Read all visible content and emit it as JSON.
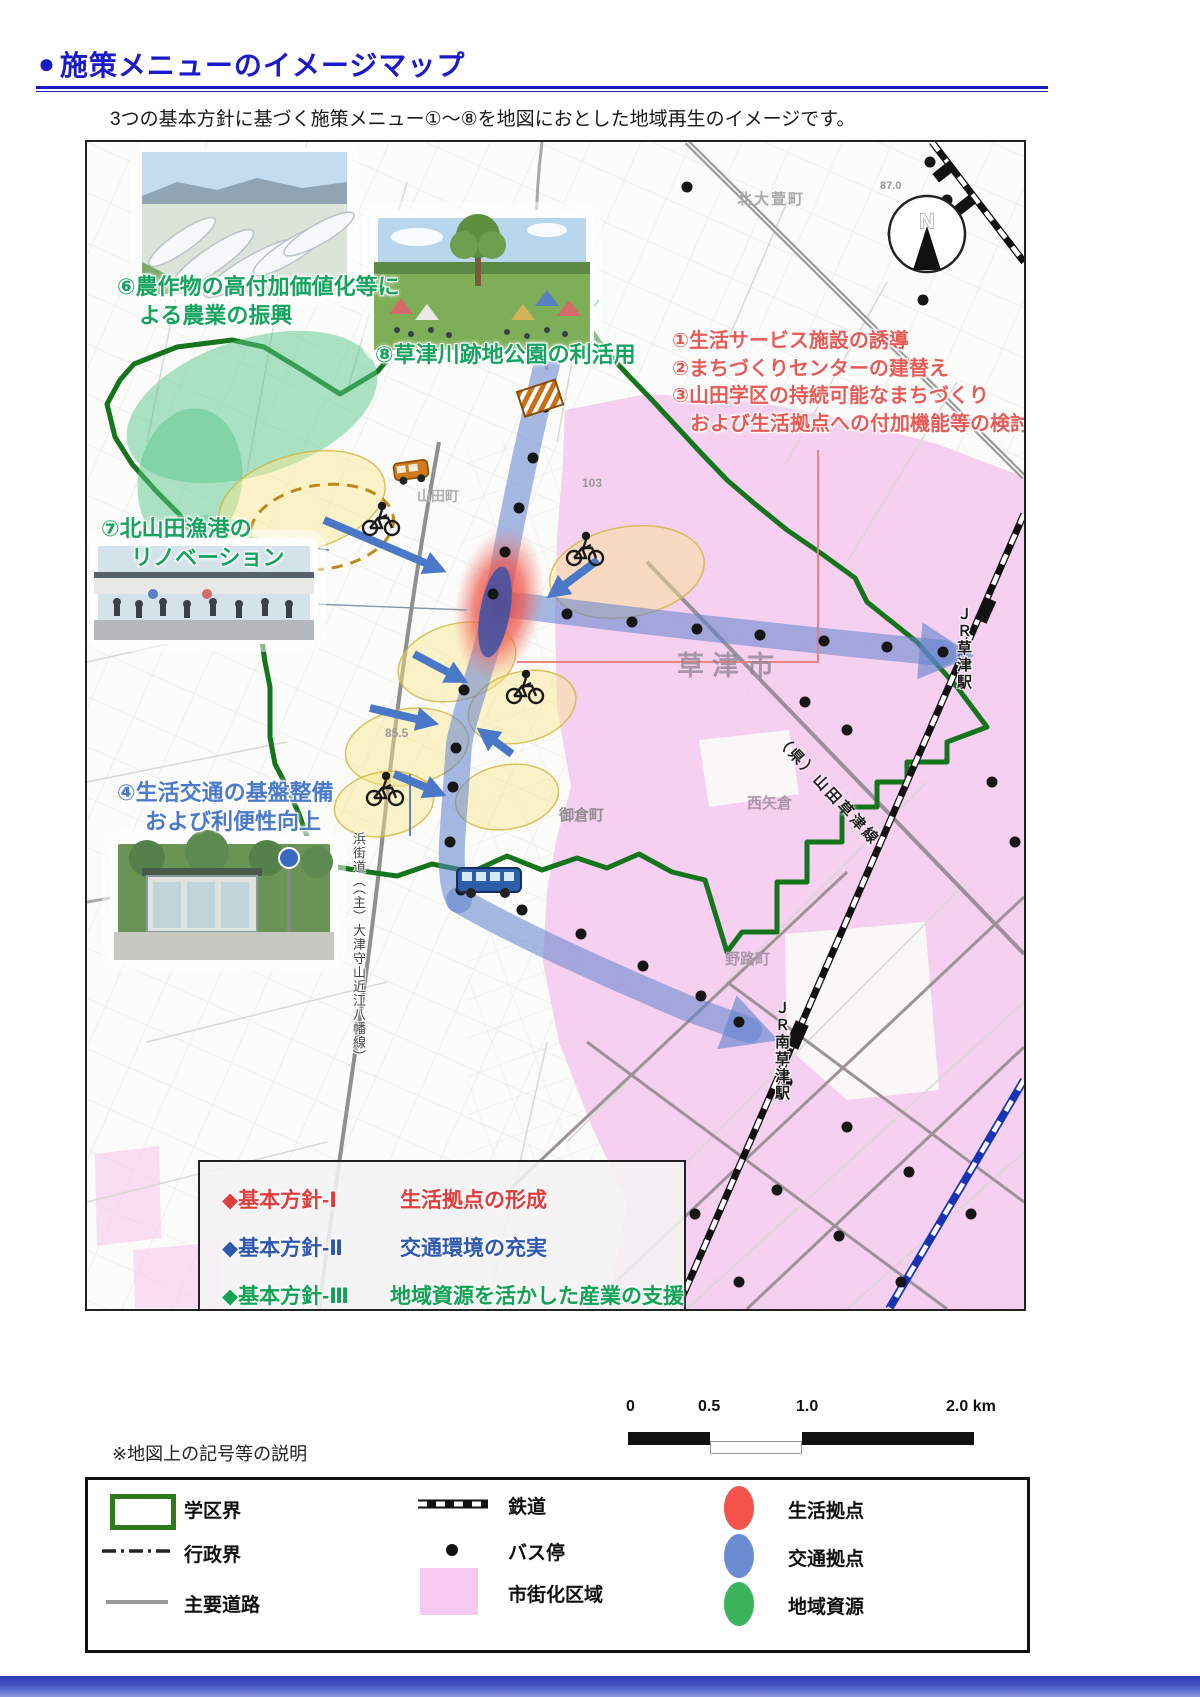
{
  "header": {
    "bullet": "●",
    "title": "施策メニューのイメージマップ",
    "subtitle": "3つの基本方針に基づく施策メニュー①〜⑧を地図におとした地域再生のイメージです。"
  },
  "map": {
    "north_label": "N",
    "annotations": {
      "menu6": {
        "line1": "⑥農作物の高付加価値化等に",
        "line2": "よる農業の振興"
      },
      "menu8": {
        "line1": "⑧草津川跡地公園の利活用"
      },
      "menu7": {
        "line1": "⑦北山田漁港の",
        "line2": "リノベーション"
      },
      "menu123": {
        "line1": "①生活サービス施設の誘導",
        "line2": "②まちづくりセンターの建替え",
        "line3": "③山田学区の持続可能なまちづくり",
        "line4": "および生活拠点への付加機能等の検討"
      },
      "menu4": {
        "line1": "④生活交通の基盤整備",
        "line2": "および利便性向上"
      }
    },
    "place_labels": {
      "kusatsu_station": "ＪＲ草津駅",
      "minami_kusatsu_station": "ＪＲ南草津駅",
      "yamada_kusatsu_line": "（県）山田草津線",
      "hama_kaido": "浜街道（（主）大津守山近江八幡線）",
      "kita_ogaya": "北大萱町",
      "kusatsu_city": "草津市",
      "yamada": "山田町",
      "mikura": "御倉町",
      "noji": "野路町",
      "nishi_yagura": "西矢倉",
      "elev1": "87.0",
      "elev2": "103",
      "elev3": "85.5"
    },
    "policy_box": {
      "items": [
        {
          "label": "◆基本方針-Ⅰ",
          "desc": "生活拠点の形成"
        },
        {
          "label": "◆基本方針-Ⅱ",
          "desc": "交通環境の充実"
        },
        {
          "label": "◆基本方針-Ⅲ",
          "desc": "地域資源を活かした産業の支援"
        }
      ]
    },
    "scale_bar": {
      "t0": "0",
      "t1": "0.5",
      "t2": "1.0",
      "t3": "2.0 km"
    }
  },
  "legend": {
    "note": "※地図上の記号等の説明",
    "items": {
      "district": "学区界",
      "admin": "行政界",
      "road": "主要道路",
      "rail": "鉄道",
      "bus": "バス停",
      "urban": "市街化区域",
      "life": "生活拠点",
      "transport": "交通拠点",
      "resource": "地域資源"
    }
  },
  "theme": {
    "title_blue": "#1a1ac8",
    "anno_red": "#e85a55",
    "anno_green": "#16a35f",
    "anno_blue": "#4b7ac8",
    "policy_red": "#e23d3d",
    "policy_blue": "#2f58b0",
    "policy_green": "#12a254",
    "urban_pink": "#f6c9f0",
    "boundary_green": "#15751c",
    "corridor_blue": "#5f82cc",
    "resource_green": "#57c08a",
    "resource_green2": "#3cb45c",
    "hub_red": "#f25248",
    "hub_blue": "#6b8bd2"
  }
}
